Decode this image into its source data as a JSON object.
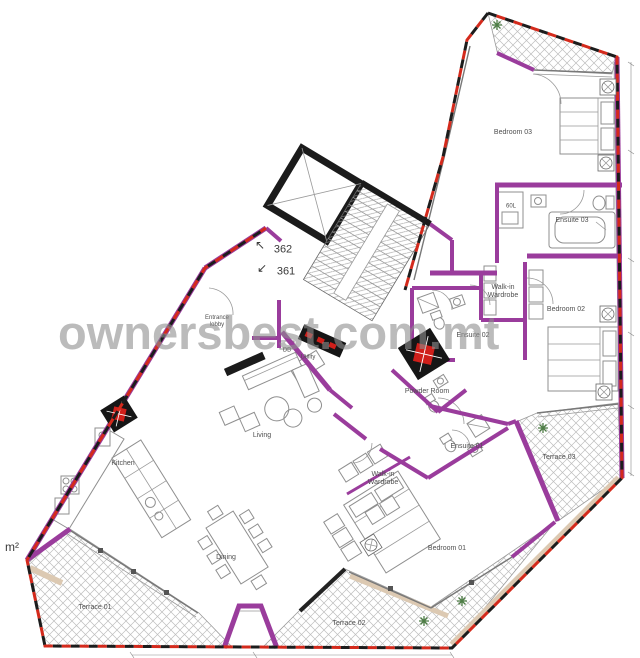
{
  "watermark": {
    "text": "ownersbest.com.mt"
  },
  "colors": {
    "wall_purple": "#9a3c9c",
    "boundary_red": "#d42a1c",
    "boundary_black": "#1c1c1c",
    "shaft_red": "#cf1f1a",
    "tan": "#dcc9b2",
    "plant_green": "#4e7d46",
    "label_gray": "#4f4f4f",
    "watermark_gray": "#8f8f8f"
  },
  "plan": {
    "unit_numbers": [
      "362",
      "361"
    ],
    "labels": [
      {
        "name": "label-bedroom-03",
        "text": "Bedroom 03",
        "x": 513,
        "y": 133,
        "size": 7
      },
      {
        "name": "label-ensuite-03",
        "text": "Ensuite 03",
        "x": 572,
        "y": 221,
        "size": 7
      },
      {
        "name": "label-boiler-60l",
        "text": "60L",
        "x": 511,
        "y": 207,
        "size": 6
      },
      {
        "name": "label-walkin-wardrobe-upper",
        "text": "Walk-in\nWardrobe",
        "x": 503,
        "y": 292,
        "size": 7
      },
      {
        "name": "label-bedroom-02",
        "text": "Bedroom 02",
        "x": 566,
        "y": 310,
        "size": 7
      },
      {
        "name": "label-ensuite-02",
        "text": "Ensuite 02",
        "x": 473,
        "y": 336,
        "size": 7
      },
      {
        "name": "label-powder-room",
        "text": "Powder Room",
        "x": 427,
        "y": 392,
        "size": 7
      },
      {
        "name": "label-ensuite-01",
        "text": "Ensuite 01",
        "x": 467,
        "y": 447,
        "size": 7
      },
      {
        "name": "label-walkin-wardrobe-lower",
        "text": "Walk-in\nWardrobe",
        "x": 383,
        "y": 479,
        "size": 7
      },
      {
        "name": "label-bedroom-01",
        "text": "Bedroom 01",
        "x": 447,
        "y": 549,
        "size": 7
      },
      {
        "name": "label-terrace-03",
        "text": "Terrace 03",
        "x": 559,
        "y": 458,
        "size": 7
      },
      {
        "name": "label-terrace-02",
        "text": "Terrace 02",
        "x": 349,
        "y": 624,
        "size": 7
      },
      {
        "name": "label-terrace-01",
        "text": "Terrace 01",
        "x": 95,
        "y": 608,
        "size": 7
      },
      {
        "name": "label-kitchen",
        "text": "Kitchen",
        "x": 123,
        "y": 464,
        "size": 7
      },
      {
        "name": "label-living",
        "text": "Living",
        "x": 262,
        "y": 436,
        "size": 7
      },
      {
        "name": "label-dining",
        "text": "Dining",
        "x": 226,
        "y": 558,
        "size": 7
      },
      {
        "name": "label-entrance-lobby",
        "text": "Entrance\nlobby",
        "x": 217,
        "y": 322,
        "size": 6
      },
      {
        "name": "label-utility",
        "text": "Utility",
        "x": 308,
        "y": 358,
        "size": 6
      },
      {
        "name": "label-db",
        "text": "DB",
        "x": 287,
        "y": 351,
        "size": 6
      },
      {
        "name": "unit-number-362",
        "text": "362",
        "x": 283,
        "y": 250,
        "size": 11,
        "color": "#3a3a3a"
      },
      {
        "name": "unit-number-361",
        "text": "361",
        "x": 286,
        "y": 272,
        "size": 11,
        "color": "#3a3a3a"
      },
      {
        "name": "arrow-up-left-icon",
        "text": "↖",
        "x": 260,
        "y": 246,
        "size": 12,
        "color": "#3a3a3a"
      },
      {
        "name": "arrow-down-left-icon",
        "text": "↙",
        "x": 262,
        "y": 269,
        "size": 12,
        "color": "#3a3a3a"
      },
      {
        "name": "label-area-sqm",
        "text": "m²",
        "x": 12,
        "y": 548,
        "size": 12,
        "color": "#3a3a3a"
      }
    ]
  }
}
